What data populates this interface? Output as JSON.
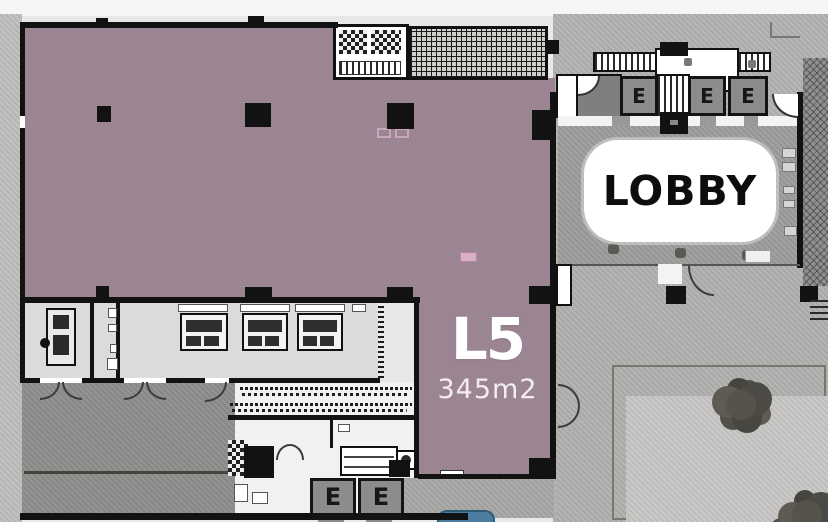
{
  "unit": {
    "label": "L5",
    "area": "345m2"
  },
  "lobby": {
    "label": "LOBBY"
  },
  "elevators": {
    "top": [
      "E",
      "E",
      "E"
    ],
    "bottom": [
      "E",
      "E"
    ]
  },
  "colors": {
    "unit_fill": "#9b8593",
    "unit_highlight": "#d9aec6",
    "wall": "#121212",
    "lobby_floor": "#9e9d9b",
    "label_bg": "#ffffff",
    "label_text": "#0d0d0d",
    "unit_text": "#ffffff",
    "plaza": "#b2b1af",
    "plaza_inner": "#c8c7c5",
    "concrete": "#b4b3b1",
    "sidewalk": "#c0bfbd",
    "ramp": "#8f8e8c",
    "room_floor": "#dcdbd9",
    "corridor": "#f2f1ef",
    "elevator_box": "#8d8c8a",
    "tree": "#55534c",
    "accent_blue": "#4c7c9f"
  }
}
